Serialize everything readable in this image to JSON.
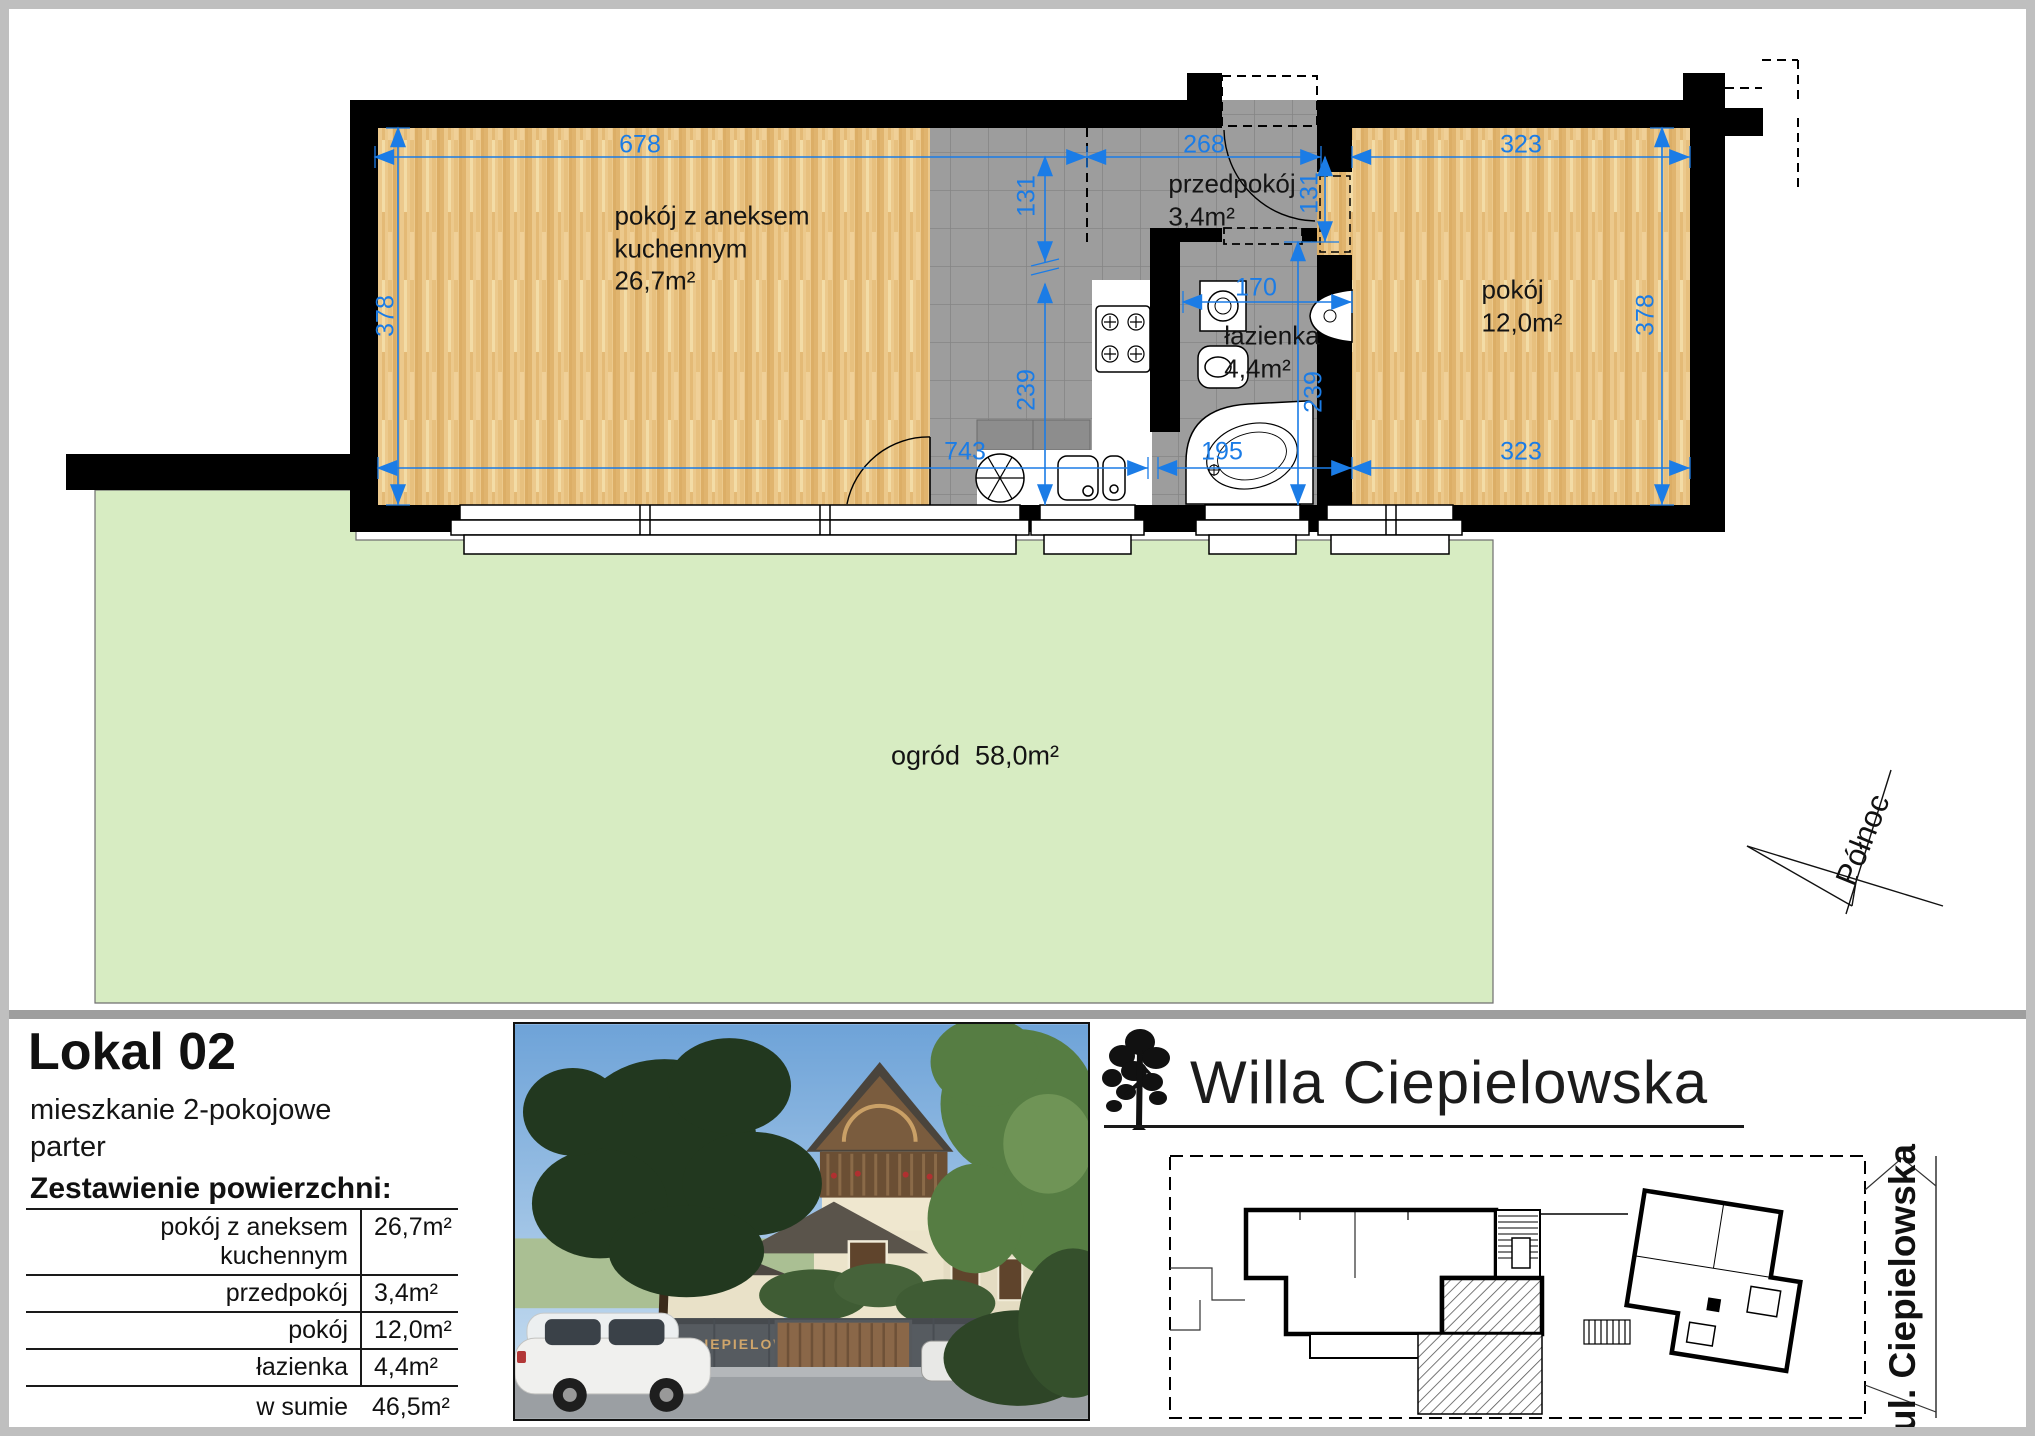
{
  "plan": {
    "rooms": {
      "living": {
        "label": "pokój z aneksem\nkuchennym\n26,7m²"
      },
      "hall": {
        "label": "przedpokój\n3,4m²"
      },
      "bath": {
        "label": "łazienka\n4,4m²"
      },
      "bedroom": {
        "label": "pokój\n12,0m²"
      },
      "garden": {
        "label": "ogród  58,0m²"
      }
    },
    "dims": {
      "living_width_top": "678",
      "hall_width_top": "268",
      "bedroom_width_top": "323",
      "living_height": "378",
      "bedroom_height": "378",
      "hall_depth_left": "131",
      "hall_depth_right": "131",
      "kitchen_depth": "239",
      "bath_depth": "239",
      "bath_width_top": "170",
      "bath_width_bottom": "195",
      "living_width_bottom": "743",
      "bedroom_width_bottom": "323"
    },
    "north_label": "Północ"
  },
  "info": {
    "title": "Lokal 02",
    "subtitle1": "mieszkanie 2-pokojowe",
    "subtitle2": "parter",
    "table_title": "Zestawienie powierzchni:",
    "rows": [
      {
        "label": "pokój z aneksem kuchennym",
        "value": "26,7m²"
      },
      {
        "label": "przedpokój",
        "value": "3,4m²"
      },
      {
        "label": "pokój",
        "value": "12,0m²"
      },
      {
        "label": "łazienka",
        "value": "4,4m²"
      }
    ],
    "summary_rows": [
      {
        "label": "w sumie",
        "value": "46,5m²"
      },
      {
        "label": "+ ogród",
        "value": "58m²"
      }
    ]
  },
  "branding": {
    "logo_text": "Willa Ciepielowska",
    "photo_sign": "CIEPIELOWSKA 10"
  },
  "siteplan": {
    "street_label": "ul. Ciepielowska"
  },
  "colors": {
    "dimension_blue": "#1b7ce6",
    "garden_green": "#d7ecc2",
    "wood": "#e9c383",
    "tile_gray": "#9d9d9d"
  }
}
